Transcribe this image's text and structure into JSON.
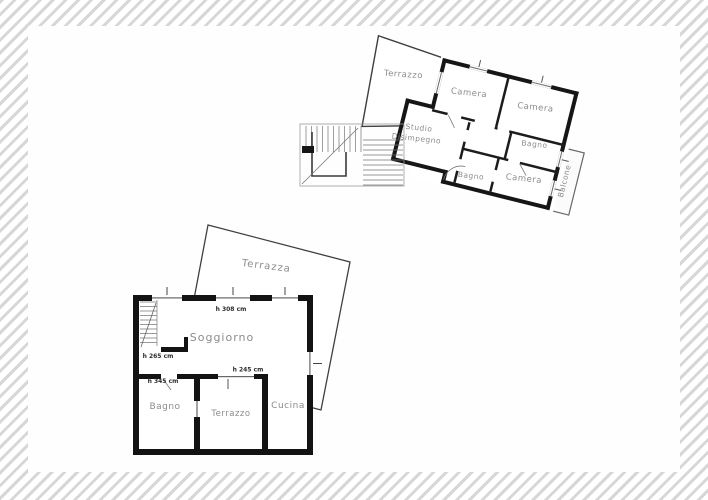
{
  "upper_plan": {
    "rooms": {
      "terrazzo": "Terrazzo",
      "camera_1": "Camera",
      "camera_2": "Camera",
      "bagno_1": "Bagno",
      "studio_line_1": "Studio",
      "studio_line_2": "Disimpegno",
      "bagno_2": "Bagno",
      "camera_3": "Camera",
      "balcone": "Balcone"
    }
  },
  "lower_plan": {
    "rooms": {
      "terrazza": "Terrazza",
      "soggiorno": "Soggiorno",
      "bagno": "Bagno",
      "terrazzo": "Terrazzo",
      "cucina": "Cucina"
    },
    "annotations": {
      "soggiorno_height": "h 308 cm",
      "stair_height": "h 265 cm",
      "bagno_height": "h 345 cm",
      "terrazzo_height": "h 245 cm"
    }
  },
  "colors": {
    "wall": "#161616",
    "label": "#8c8c8c",
    "annotation": "#2e2e2e",
    "thin_line": "#666666",
    "frame_hatch": "#d7d7d7",
    "background": "#ffffff"
  }
}
